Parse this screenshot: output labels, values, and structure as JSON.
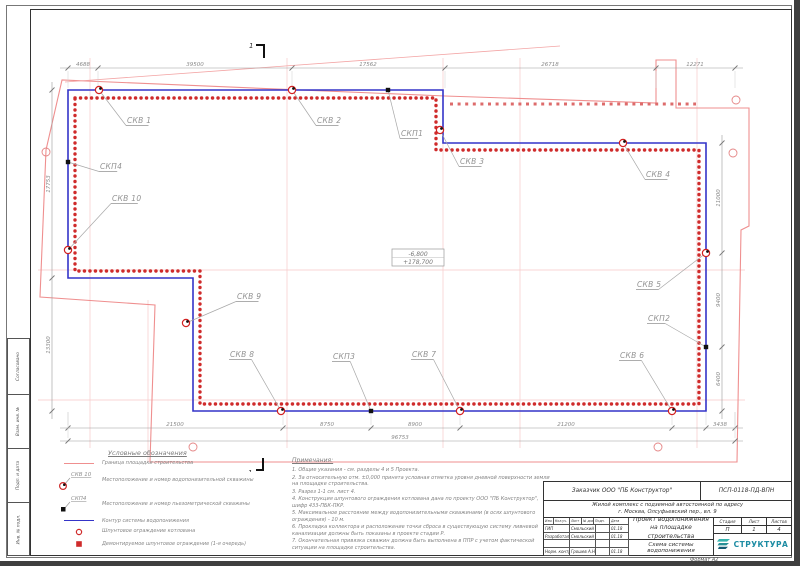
{
  "colors": {
    "contour_blue": "#3434c8",
    "piling_red": "#cf2b2b",
    "boundary_pink": "#ef8f8f",
    "axis_pink": "#f6c9c9",
    "label_gray": "#929292",
    "dim_gray": "#8a8a8a",
    "logo_teal": "#1d8ca3"
  },
  "plan": {
    "section_mark": "1",
    "elevation": {
      "line1": "-6,800",
      "line2": "+178,700"
    },
    "wells": [
      {
        "id": "СКВ 1",
        "type": "water",
        "x": 99,
        "y": 90,
        "lx": 127,
        "ly": 123
      },
      {
        "id": "СКВ 2",
        "type": "water",
        "x": 292,
        "y": 90,
        "lx": 317,
        "ly": 123
      },
      {
        "id": "СКП1",
        "type": "piezo",
        "x": 388,
        "y": 90,
        "lx": 401,
        "ly": 136
      },
      {
        "id": "СКВ 3",
        "type": "water",
        "x": 440,
        "y": 130,
        "lx": 460,
        "ly": 164
      },
      {
        "id": "СКВ 4",
        "type": "water",
        "x": 623,
        "y": 143,
        "lx": 646,
        "ly": 177
      },
      {
        "id": "СКВ 5",
        "type": "water",
        "x": 706,
        "y": 253,
        "lx": 637,
        "ly": 287
      },
      {
        "id": "СКП2",
        "type": "piezo",
        "x": 706,
        "y": 347,
        "lx": 648,
        "ly": 321
      },
      {
        "id": "СКВ 6",
        "type": "water",
        "x": 672,
        "y": 411,
        "lx": 620,
        "ly": 358
      },
      {
        "id": "СКВ 7",
        "type": "water",
        "x": 460,
        "y": 411,
        "lx": 412,
        "ly": 357
      },
      {
        "id": "СКП3",
        "type": "piezo",
        "x": 371,
        "y": 411,
        "lx": 333,
        "ly": 359
      },
      {
        "id": "СКВ 8",
        "type": "water",
        "x": 281,
        "y": 411,
        "lx": 230,
        "ly": 357
      },
      {
        "id": "СКВ 9",
        "type": "water",
        "x": 186,
        "y": 323,
        "lx": 237,
        "ly": 299
      },
      {
        "id": "СКВ 10",
        "type": "water",
        "x": 68,
        "y": 250,
        "lx": 112,
        "ly": 201
      },
      {
        "id": "СКП4",
        "type": "piezo",
        "x": 68,
        "y": 162,
        "lx": 100,
        "ly": 169
      }
    ],
    "dims": {
      "top": {
        "y": 68,
        "ticks": [
          68,
          98,
          292,
          445,
          656,
          735
        ],
        "labels": [
          {
            "t": "4688",
            "x": 83
          },
          {
            "t": "39500",
            "x": 195
          },
          {
            "t": "17562",
            "x": 368
          },
          {
            "t": "26718",
            "x": 550
          },
          {
            "t": "12271",
            "x": 695
          }
        ]
      },
      "bottom": {
        "y": 428,
        "ticks": [
          68,
          283,
          371,
          460,
          672,
          706,
          735
        ],
        "labels": [
          {
            "t": "21500",
            "x": 175
          },
          {
            "t": "8750",
            "x": 327
          },
          {
            "t": "8900",
            "x": 415
          },
          {
            "t": "21200",
            "x": 566
          },
          {
            "t": "3438",
            "x": 720
          }
        ]
      },
      "bottom_total": {
        "y": 441,
        "ticks": [
          68,
          735
        ],
        "labels": [
          {
            "t": "96753",
            "x": 400
          }
        ]
      },
      "left": {
        "x": 52,
        "ticks": [
          90,
          278,
          411
        ],
        "labels": [
          {
            "t": "17753",
            "y": 184
          },
          {
            "t": "13300",
            "y": 345
          }
        ]
      },
      "right": {
        "x": 722,
        "ticks": [
          143,
          253,
          347,
          411
        ],
        "labels": [
          {
            "t": "11000",
            "y": 198
          },
          {
            "t": "9400",
            "y": 300
          },
          {
            "t": "6400",
            "y": 379
          }
        ]
      }
    }
  },
  "legend": {
    "title": "Условные обозначения",
    "items": [
      {
        "sym": "boundary-line",
        "label": "",
        "text": "Граница площадки строительства"
      },
      {
        "sym": "water-well",
        "label": "СКВ 10",
        "text": "Местоположение и номер водопонизительной скважины"
      },
      {
        "sym": "piezo-well",
        "label": "СКП4",
        "text": "Местоположение и номер пьезометрической скважины"
      },
      {
        "sym": "contour-line",
        "label": "",
        "text": "Контур системы водопонижения"
      },
      {
        "sym": "sheet-pile",
        "label": "",
        "text": "Шпунтовое ограждение котлована"
      },
      {
        "sym": "sheet-pile-removed",
        "label": "",
        "text": "Демонтируемое шпунтовое ограждение (1-я очередь)"
      }
    ]
  },
  "notes": {
    "title": "Примечания:",
    "items": [
      "1. Общие указания - см. разделы 4 и 5 Проекта.",
      "2. За относительную отм. ±0,000 принята условная отметка уровня дневной поверхности земли на площадке строительства.",
      "3. Разрез 1-1 см. лист 4.",
      "4. Конструкция шпунтового ограждения котлована дана по проекту ООО \"ПБ Конструктор\", шифр 433-ПБК-ПКР.",
      "5. Максимальное расстояние между водопонизительными скважинами (в осях шпунтового ограждения) - 10 м.",
      "6. Прокладка коллектора и расположение точки сброса в существующую систему ливневой канализации должны быть показаны в проекте стадии Р.",
      "7. Окончательная привязка скважин должна быть выполнена в ППР с учетом фактической ситуации на площадке строительства."
    ]
  },
  "titleblock": {
    "customer": "Заказчик ООО \"ПБ Конструктор\"",
    "code": "ПСП-0118-ПД-ВПН",
    "object_line1": "Жилой комплекс с подземной автостоянкой по адресу",
    "object_line2": "г. Москва, Олсуфьевский пер., вл. 9",
    "sig_header": [
      "Изм.",
      "Кол.уч.",
      "Лист",
      "№ док.",
      "Подп.",
      "Дата"
    ],
    "sig_rows": [
      {
        "role": "ГИП",
        "name": "Смольский А.Л.",
        "sign": "",
        "date": "01.18"
      },
      {
        "role": "Разработал",
        "name": "Смольский А.Л.",
        "sign": "",
        "date": "01.18"
      },
      {
        "role": "",
        "name": "",
        "sign": "",
        "date": ""
      },
      {
        "role": "Норм. контр.",
        "name": "Грошев А.Н.",
        "sign": "",
        "date": "01.18"
      }
    ],
    "project_line1": "Проект водопонижения",
    "project_line2": "на площадке строительства",
    "sheet_title": "Схема системы водопонижения",
    "stage_label": "Стадия",
    "sheet_label": "Лист",
    "sheets_label": "Листов",
    "stage": "П",
    "sheet": "1",
    "sheets": "4",
    "logo": "СТРУКТУРА",
    "format": "Формат А2"
  },
  "side_stamp": [
    "Согласовано",
    "Взам. инв. №",
    "Подп. и дата",
    "Инв. № подл."
  ]
}
